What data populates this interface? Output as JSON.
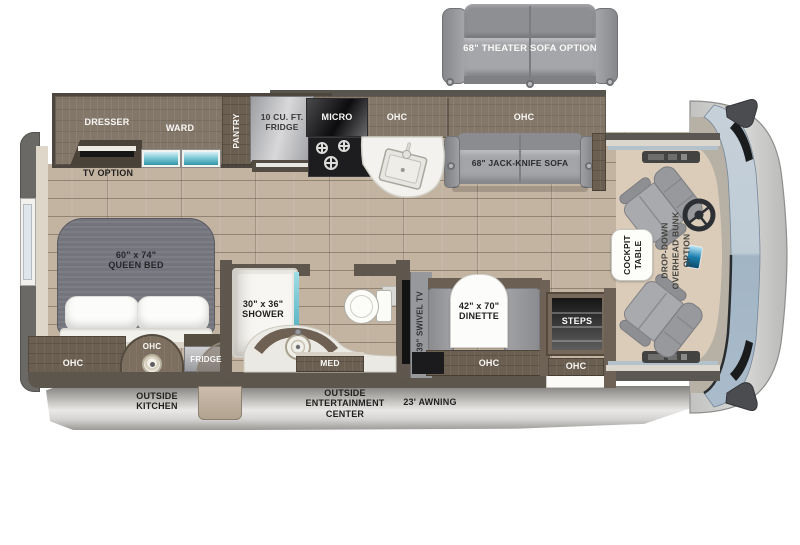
{
  "title": "Motorhome floor plan",
  "labels": {
    "theater_sofa": "68\" THEATER SOFA OPTION",
    "dresser": "DRESSER",
    "ward": "WARD",
    "pantry": "PANTRY",
    "main_fridge_l1": "10 CU. FT.",
    "main_fridge_l2": "FRIDGE",
    "micro": "MICRO",
    "ohc_kitchen": "OHC",
    "ohc_living": "OHC",
    "jack_knife_sofa": "68\" JACK-KNIFE SOFA",
    "tv_option": "TV OPTION",
    "queen_bed_l1": "60\" x 74\"",
    "queen_bed_l2": "QUEEN BED",
    "ohc_bedroom": "OHC",
    "ohc_outside_kitchen": "OHC",
    "outside_fridge": "FRIDGE",
    "shower_l1": "30\" x 36\"",
    "shower_l2": "SHOWER",
    "med": "MED",
    "swivel_tv": "39\" SWIVEL TV",
    "dinette_l1": "42\" x 70\"",
    "dinette_l2": "DINETTE",
    "ohc_dinette": "OHC",
    "steps": "STEPS",
    "ohc_entry": "OHC",
    "cockpit_table_l1": "COCKPIT",
    "cockpit_table_l2": "TABLE",
    "bunk_l1": "DROP-DOWN",
    "bunk_l2": "OVERHEAD BUNK",
    "bunk_l3": "OPTION",
    "outside_kitchen_l1": "OUTSIDE",
    "outside_kitchen_l2": "KITCHEN",
    "entertainment_l1": "OUTSIDE",
    "entertainment_l2": "ENTERTAINMENT",
    "entertainment_l3": "CENTER",
    "awning": "23' AWNING"
  },
  "colors": {
    "floor_wood": "#c3b4a2",
    "cabinet_wood": "#83776a",
    "cabinet_dark": "#6b5f52",
    "wall": "#5d564c",
    "upholstery_gray": "#a4a5a9",
    "window_teal": "#7fcbd8",
    "body_silver": "#d9d8d6",
    "windshield_blue": "#aabccb",
    "counter_white": "#f3f2ee"
  }
}
